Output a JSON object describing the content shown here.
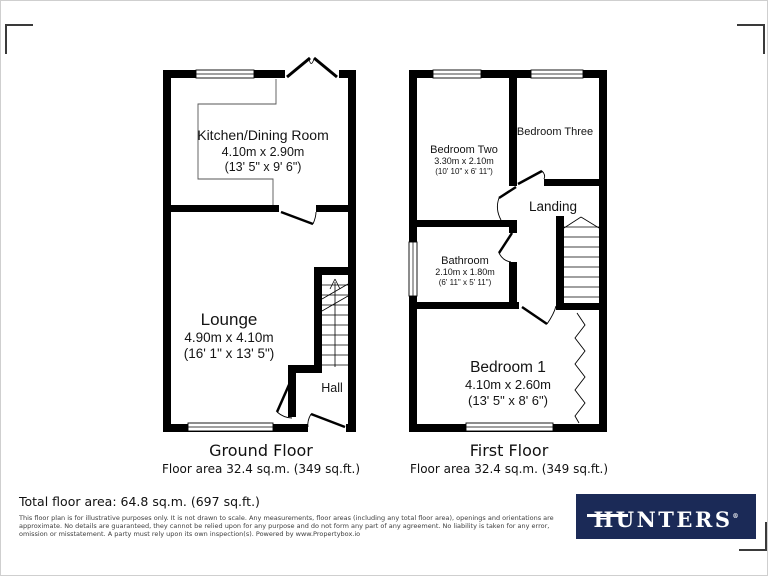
{
  "floorplan": {
    "ground": {
      "caption": "Ground Floor",
      "area": "Floor area 32.4 sq.m. (349 sq.ft.)",
      "kitchen_name": "Kitchen/Dining Room",
      "kitchen_metric": "4.10m x 2.90m",
      "kitchen_imperial": "(13' 5\" x 9' 6\")",
      "lounge_name": "Lounge",
      "lounge_metric": "4.90m x 4.10m",
      "lounge_imperial": "(16' 1\" x 13' 5\")",
      "hall_name": "Hall"
    },
    "first": {
      "caption": "First Floor",
      "area": "Floor area 32.4 sq.m. (349 sq.ft.)",
      "bedroom2_name": "Bedroom Two",
      "bedroom2_metric": "3.30m x 2.10m",
      "bedroom2_imperial": "(10' 10\" x 6' 11\")",
      "bedroom3_name": "Bedroom Three",
      "landing_name": "Landing",
      "bathroom_name": "Bathroom",
      "bathroom_metric": "2.10m x 1.80m",
      "bathroom_imperial": "(6' 11\" x 5' 11\")",
      "bedroom1_name": "Bedroom 1",
      "bedroom1_metric": "4.10m x 2.60m",
      "bedroom1_imperial": "(13' 5\" x 8' 6\")"
    }
  },
  "summary": {
    "total_area": "Total floor area: 64.8 sq.m. (697 sq.ft.)",
    "disclaimer_line1": "This floor plan is for illustrative purposes only. It is not drawn to scale. Any measurements, floor areas (including any total floor area), openings and orientations are",
    "disclaimer_line2": "approximate. No details are guaranteed, they cannot be relied upon for any purpose and do not form any part of any agreement. No liability is taken for any error,",
    "disclaimer_line3": "omission or misstatement. A party must rely upon its own inspection(s). Powered by www.Propertybox.io"
  },
  "brand": {
    "name": "HUNTERS",
    "registered": "®",
    "bg_color": "#1b2a57",
    "text_color": "#ffffff"
  },
  "colors": {
    "wall": "#000000",
    "thin_line": "#555555"
  }
}
